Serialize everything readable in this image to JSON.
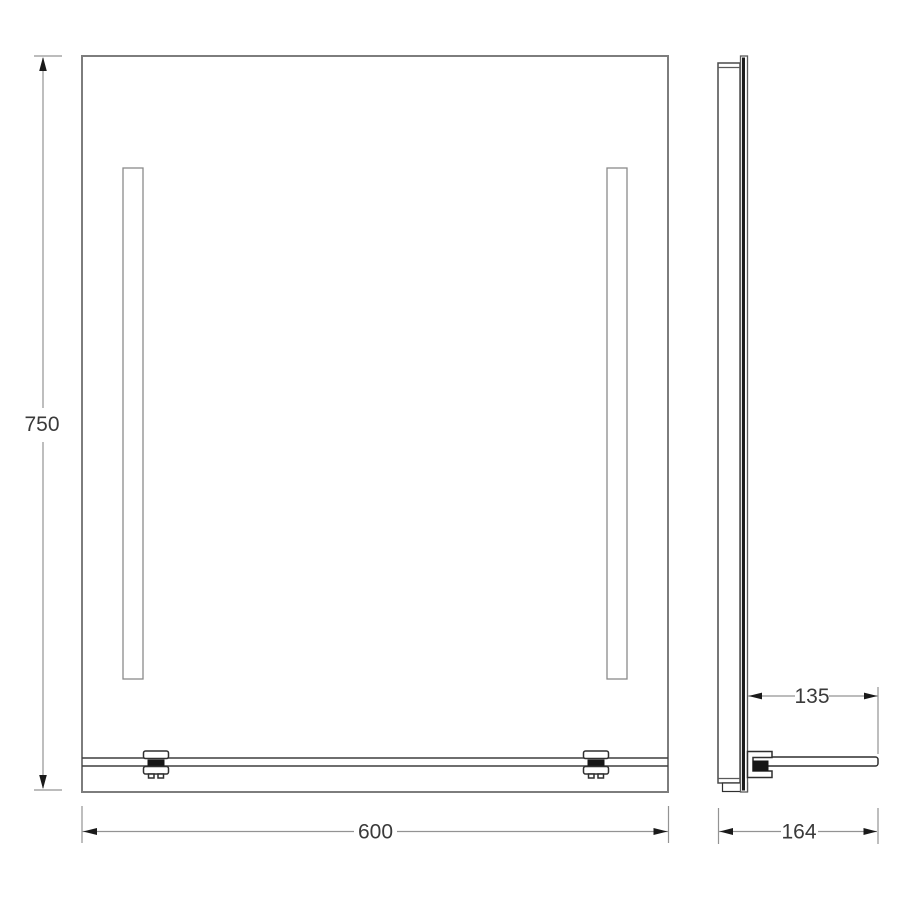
{
  "drawing": {
    "title": "mirror-with-shelf-technical-drawing",
    "views": {
      "front": {
        "name": "front view: illuminated mirror with two vertical LED strips and bottom shelf"
      },
      "side": {
        "name": "side view: mirror profile with projecting shelf"
      }
    },
    "dimensions": {
      "height": "750",
      "width": "600",
      "shelf_depth": "135",
      "overall_depth": "164"
    },
    "colors": {
      "background": "#ffffff",
      "outline": "#7d7d7d",
      "detail_line": "#3f3f3f",
      "dimension_line": "#939393",
      "arrow_and_pad": "#161616",
      "text": "#3a3a3a"
    }
  }
}
